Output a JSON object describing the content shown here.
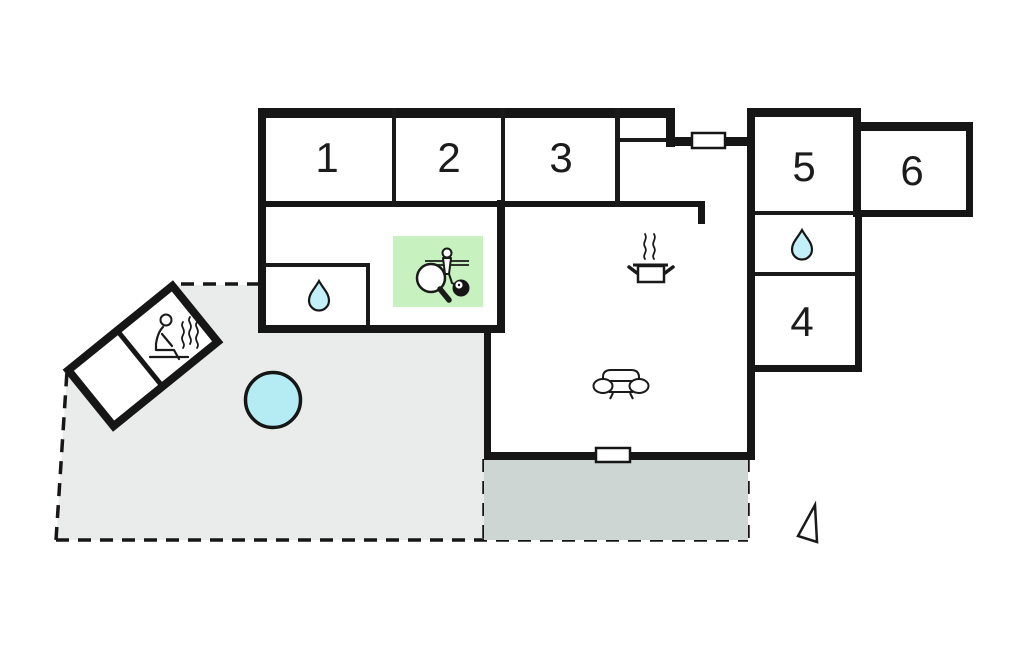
{
  "plan": {
    "type": "holiday-home-floor-plan",
    "rooms": [
      {
        "id": "bedroom-1",
        "label": "1"
      },
      {
        "id": "bedroom-2",
        "label": "2"
      },
      {
        "id": "bedroom-3",
        "label": "3"
      },
      {
        "id": "room-4",
        "label": "4"
      },
      {
        "id": "room-5",
        "label": "5"
      },
      {
        "id": "room-6",
        "label": "6"
      }
    ],
    "icons": [
      "water-drop-icon",
      "water-drop-icon",
      "sauna-person-icon",
      "pool-icon",
      "cooking-pot-icon",
      "sofa-icon",
      "table-tennis-paddle-icon",
      "foosball-player-icon",
      "billiard-ball-icon",
      "window-icon",
      "window-icon",
      "north-arrow-icon"
    ],
    "colors": {
      "wall": "#161616",
      "background": "#ffffff",
      "plot_area": "#e9eceb",
      "terrace": "#cdd6d2",
      "pool": "#b5ecf4",
      "water_drop": "#c3f0f8",
      "games_room": "#c8f1c0"
    }
  }
}
